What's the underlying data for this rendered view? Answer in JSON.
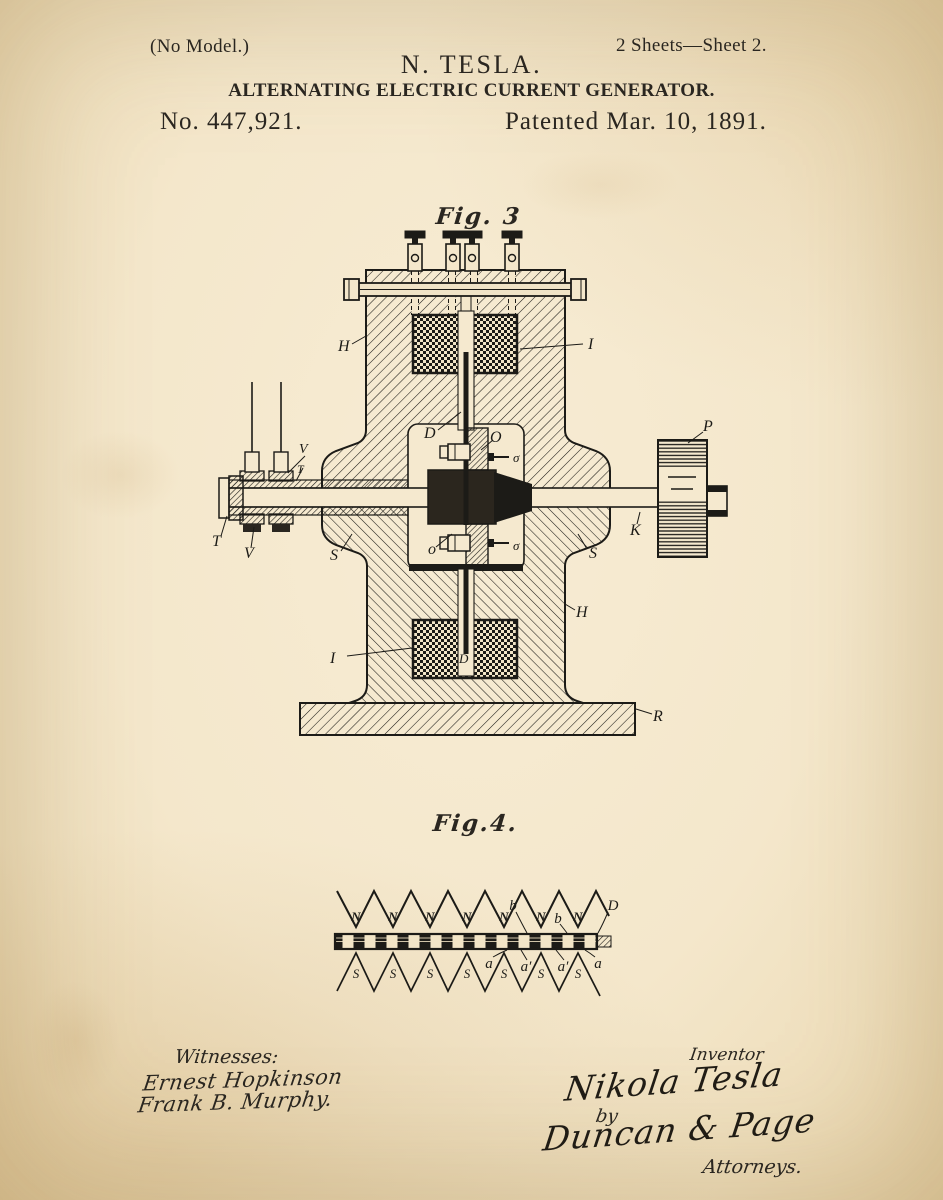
{
  "colors": {
    "paper": "#f4e7cb",
    "ink": "#1c1b17"
  },
  "header": {
    "no_model": "(No Model.)",
    "sheet_info": "2 Sheets—Sheet 2.",
    "inventor": "N. TESLA.",
    "title": "ALTERNATING ELECTRIC CURRENT GENERATOR.",
    "patent_number": "No. 447,921.",
    "patent_date": "Patented Mar. 10, 1891."
  },
  "fig3": {
    "caption": "Fig. 3",
    "labels": {
      "h": "H",
      "i": "I",
      "d": "D",
      "o_cap": "O",
      "sigma": "σ",
      "o": "o",
      "s": "S",
      "k": "K",
      "p": "P",
      "r": "R",
      "t": "T",
      "v": "V"
    }
  },
  "fig4": {
    "caption": "Fig.4.",
    "labels": {
      "n": "N",
      "s": "S",
      "b": "b",
      "a": "a",
      "a_prime": "a′",
      "d": "D"
    }
  },
  "footer": {
    "witnesses_heading": "Witnesses:",
    "witness_1": "Ernest Hopkinson",
    "witness_2": "Frank B. Murphy.",
    "inventor_heading": "Inventor",
    "inventor_signature": "Nikola Tesla",
    "by_label": "by",
    "attorney_signature": "Duncan & Page",
    "attorneys_label": "Attorneys."
  }
}
